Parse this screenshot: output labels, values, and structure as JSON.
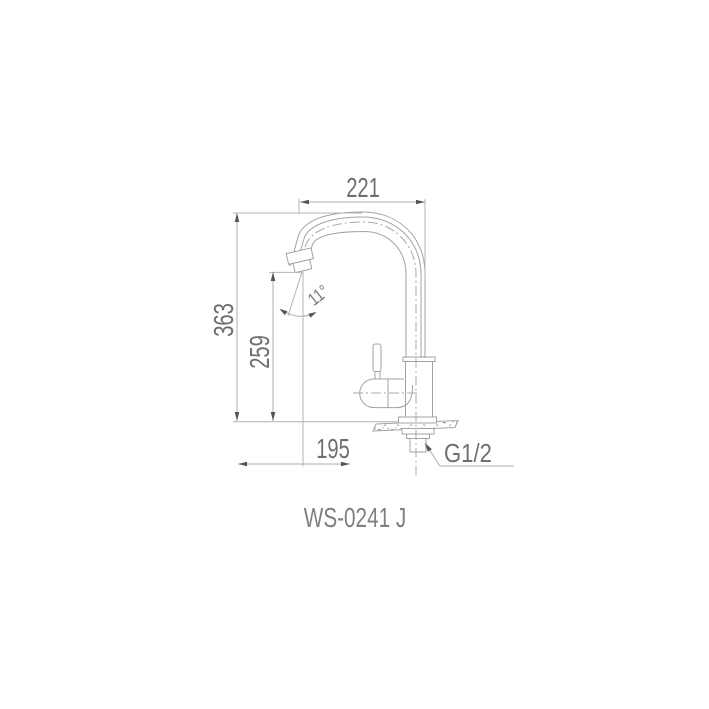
{
  "title": "Faucet technical dimension drawing",
  "model_label": "WS-0241 J",
  "dimensions": {
    "top_width": "221",
    "total_height": "363",
    "spout_height": "259",
    "bottom_offset": "195",
    "spout_angle": "11°",
    "thread_size": "G1/2"
  },
  "colors": {
    "background": "#ffffff",
    "drawing_line": "#a3a3a3",
    "dimension_line": "#adadad",
    "arrow": "#555555",
    "dimension_text": "#6f6f6f",
    "model_text": "#7f7f7f"
  }
}
